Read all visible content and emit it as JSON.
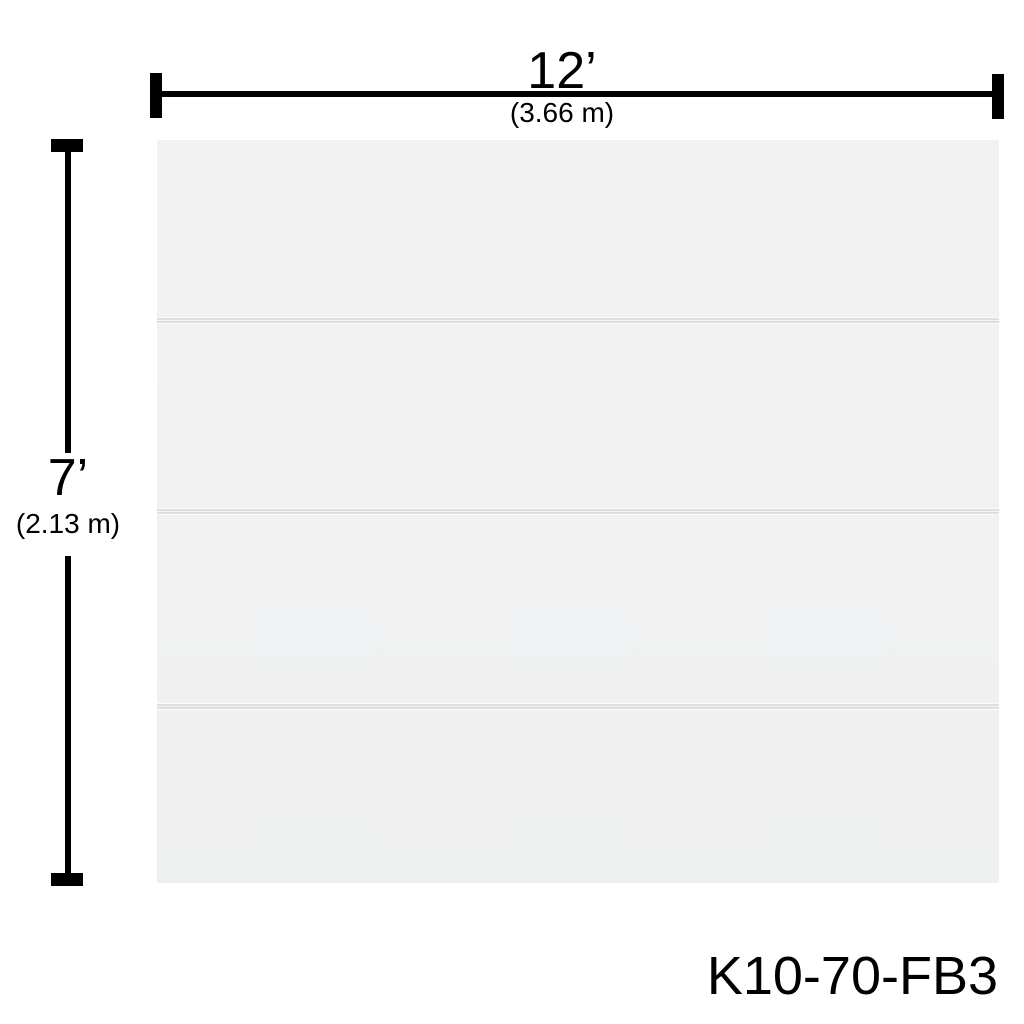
{
  "model_number": "K10-70-FB3",
  "dimensions": {
    "width": {
      "feet": "12’",
      "meters": "(3.66 m)"
    },
    "height": {
      "feet": "7’",
      "meters": "(2.13 m)"
    }
  },
  "panel": {
    "section_count": 4,
    "groove_offsets_px": [
      176,
      367,
      562
    ]
  },
  "colors": {
    "background": "#ffffff",
    "panel_fill": "#f1f1f2",
    "groove_line": "#c3c6c8",
    "dimension_ink": "#000000"
  }
}
